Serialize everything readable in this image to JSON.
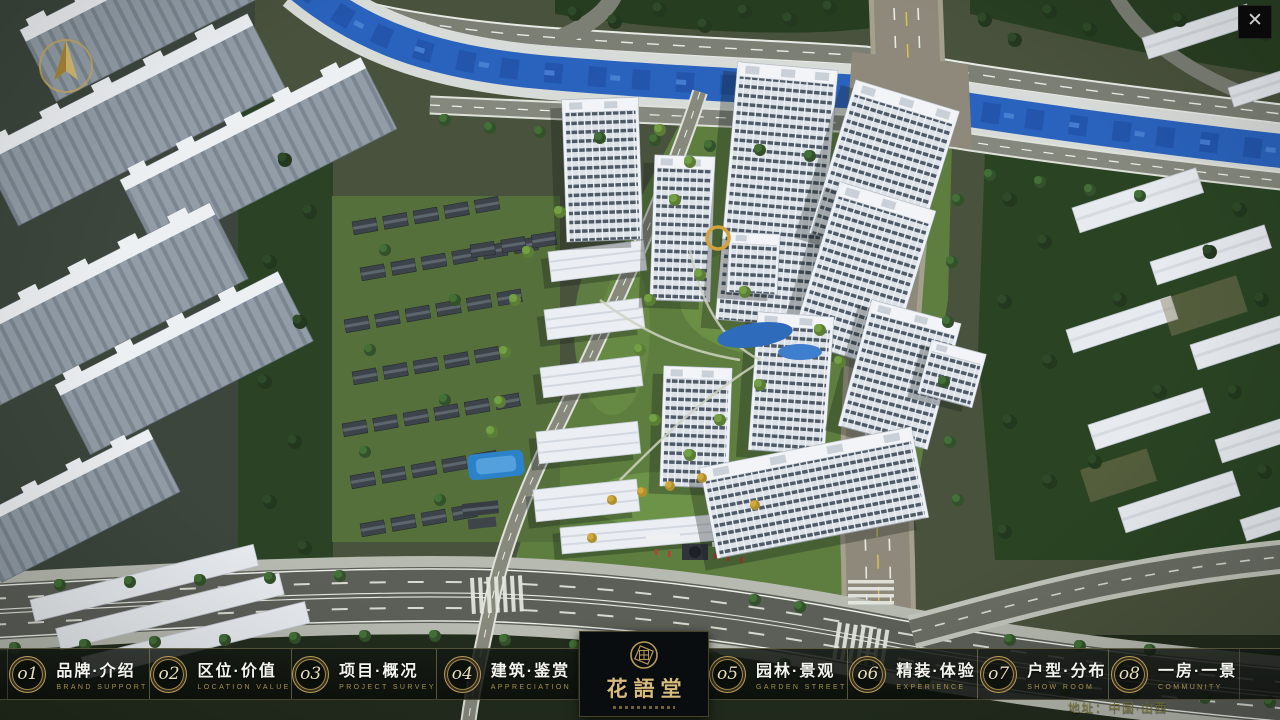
{
  "window": {
    "close_icon": "✕"
  },
  "nav": {
    "items": [
      {
        "num": "o1",
        "label": "品牌·介绍",
        "sub": "BRAND SUPPORT"
      },
      {
        "num": "o2",
        "label": "区位·价值",
        "sub": "LOCATION VALUE"
      },
      {
        "num": "o3",
        "label": "项目·概况",
        "sub": "PROJECT SURVEY"
      },
      {
        "num": "o4",
        "label": "建筑·鉴赏",
        "sub": "APPRECIATION"
      },
      {
        "num": "o5",
        "label": "园林·景观",
        "sub": "GARDEN STREET"
      },
      {
        "num": "o6",
        "label": "精装·体验",
        "sub": "EXPERIENCE"
      },
      {
        "num": "o7",
        "label": "户型·分布",
        "sub": "SHOW ROOM"
      },
      {
        "num": "o8",
        "label": "一房·一景",
        "sub": "COMMUNITY"
      }
    ]
  },
  "logo": {
    "title": "花語堂",
    "emblem_icon": "seal-icon"
  },
  "footer": {
    "address": "地址：中国·山西"
  },
  "scene": {
    "description_icons": [
      "compass-north-icon"
    ]
  },
  "colors": {
    "gold_accent": "#bb9c5c",
    "bar_background": "rgba(13,17,13,0.84)",
    "river_blue": "#2a63bd",
    "logo_gold": "#d8bc7e"
  }
}
